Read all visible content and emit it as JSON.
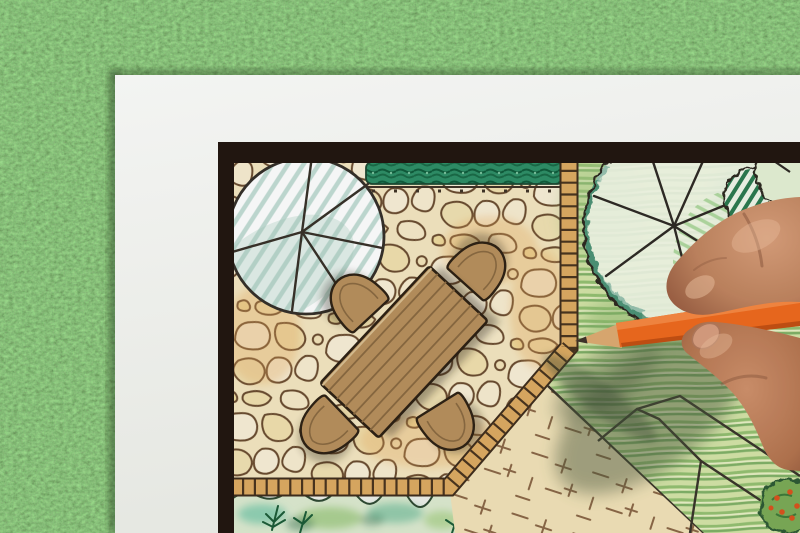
{
  "meta": {
    "type": "photograph",
    "description": "Overhead photo of a hand holding an orange colored pencil while drawing a garden landscape-architecture plan on a white sheet lying on green grass",
    "canvas": {
      "width": 800,
      "height": 533
    }
  },
  "scene": {
    "background": {
      "label": "artificial grass lawn",
      "color": "#4a7a3e"
    },
    "paper": {
      "label": "white drawing paper sheet",
      "color": "#f6f7f3"
    },
    "plan": {
      "frame": {
        "label": "dark plan border frame",
        "color": "#231711"
      },
      "elements": {
        "patio": {
          "label": "flagstone patio paving",
          "stone_color": "#f2e5bf",
          "joint_color": "#6a4c30"
        },
        "table": {
          "label": "rectangular wooden patio table",
          "color": "#b7905d"
        },
        "chairs": {
          "label": "rounded patio chairs",
          "count": 4,
          "color": "#b7905d"
        },
        "tree_left": {
          "label": "round tree canopy with radial spokes and blue hatching",
          "hatch_color": "#c2dcd4"
        },
        "hedge": {
          "label": "clipped hedge strip",
          "color": "#2f8f68"
        },
        "brick_edge": {
          "label": "brick edging strip around patio",
          "color": "#dcab63"
        },
        "lawn": {
          "label": "pencil-hatched lawn",
          "color": "#cfe0a2"
        },
        "tree_right": {
          "label": "large scalloped tree canopy with spokes",
          "shade_color": "#5fa28f"
        },
        "shrub_striped": {
          "label": "striped round shrub symbol",
          "color": "#2c7a50"
        },
        "corner_canopy": {
          "label": "partial scalloped canopy in top-right corner",
          "color": "#e4f0d4"
        },
        "sand": {
          "label": "gravel / sand area with tick hatching",
          "color": "#f1e2b8"
        },
        "planting_bed": {
          "label": "planting bed with ferns",
          "color": "#6cc0a2"
        },
        "path_outline": {
          "label": "stepping path outline on lawn"
        },
        "shrub_berries": {
          "label": "round shrub with orange berries",
          "accent": "#d9541e"
        }
      }
    },
    "hand": {
      "label": "hand gripping the pencil",
      "skin_color": "#c08a66"
    },
    "pencil": {
      "label": "orange colored pencil",
      "color": "#ee6a1e",
      "wood_color": "#ddab72",
      "tip_color": "#3f332a"
    },
    "shadow": {
      "label": "soft shadow of hand and pencil on the plan",
      "color": "#49583c"
    }
  }
}
